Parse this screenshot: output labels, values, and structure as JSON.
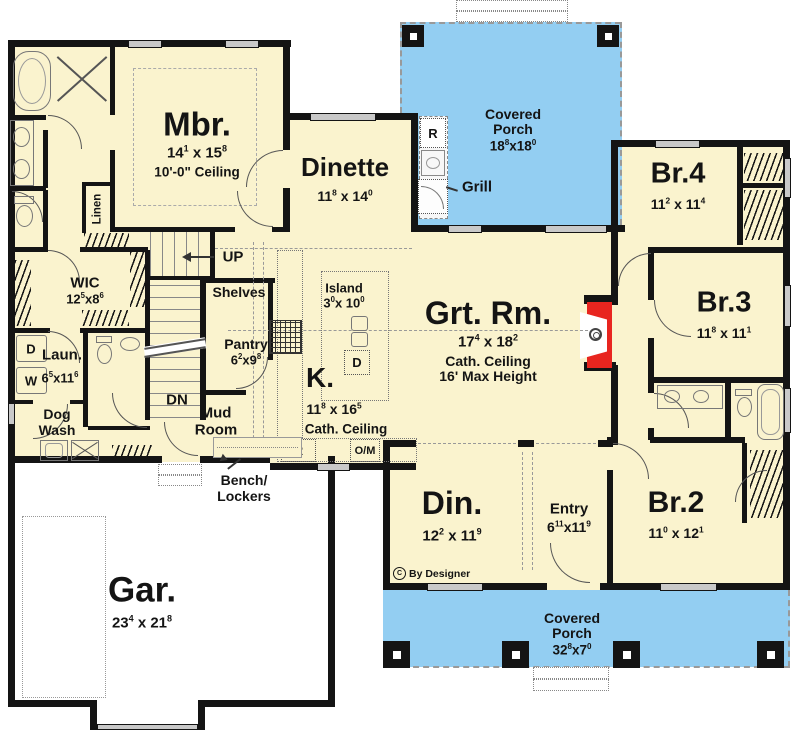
{
  "rooms": {
    "mbr": {
      "name": "Mbr.",
      "dim": [
        {
          "t": "14"
        },
        {
          "t": "1",
          "sup": true
        },
        {
          "t": " x 15"
        },
        {
          "t": "8",
          "sup": true
        }
      ],
      "note": "10'-0\" Ceiling"
    },
    "dinette": {
      "name": "Dinette",
      "dim": [
        {
          "t": "11"
        },
        {
          "t": "8",
          "sup": true
        },
        {
          "t": " x 14"
        },
        {
          "t": "0",
          "sup": true
        }
      ]
    },
    "porch_top": {
      "line1": "Covered",
      "line2": "Porch",
      "dim": [
        {
          "t": "18"
        },
        {
          "t": "8",
          "sup": true
        },
        {
          "t": "x18"
        },
        {
          "t": "0",
          "sup": true
        }
      ]
    },
    "br4": {
      "name": "Br.4",
      "dim": [
        {
          "t": "11"
        },
        {
          "t": "2",
          "sup": true
        },
        {
          "t": " x 11"
        },
        {
          "t": "4",
          "sup": true
        }
      ]
    },
    "br3": {
      "name": "Br.3",
      "dim": [
        {
          "t": "11"
        },
        {
          "t": "8",
          "sup": true
        },
        {
          "t": " x 11"
        },
        {
          "t": "1",
          "sup": true
        }
      ]
    },
    "grt": {
      "name": "Grt. Rm.",
      "dim": [
        {
          "t": "17"
        },
        {
          "t": "4",
          "sup": true
        },
        {
          "t": " x 18"
        },
        {
          "t": "2",
          "sup": true
        }
      ],
      "note1": "Cath. Ceiling",
      "note2": "16' Max Height"
    },
    "kitchen": {
      "name": "K.",
      "dim": [
        {
          "t": "11"
        },
        {
          "t": "8",
          "sup": true
        },
        {
          "t": " x 16"
        },
        {
          "t": "5",
          "sup": true
        }
      ],
      "note": "Cath. Ceiling"
    },
    "island": {
      "name": "Island",
      "dim": [
        {
          "t": "3"
        },
        {
          "t": "0",
          "sup": true
        },
        {
          "t": "x 10"
        },
        {
          "t": "0",
          "sup": true
        }
      ]
    },
    "pantry": {
      "name": "Pantry",
      "dim": [
        {
          "t": "6"
        },
        {
          "t": "2",
          "sup": true
        },
        {
          "t": "x9"
        },
        {
          "t": "8",
          "sup": true
        }
      ],
      "shelves": "Shelves"
    },
    "wic": {
      "name": "WIC",
      "dim": [
        {
          "t": "12"
        },
        {
          "t": "5",
          "sup": true
        },
        {
          "t": "x8"
        },
        {
          "t": "6",
          "sup": true
        }
      ]
    },
    "laun": {
      "name": "Laun.",
      "dim": [
        {
          "t": "6"
        },
        {
          "t": "5",
          "sup": true
        },
        {
          "t": "x11"
        },
        {
          "t": "6",
          "sup": true
        }
      ]
    },
    "dog_wash": {
      "line1": "Dog",
      "line2": "Wash"
    },
    "mud_room": {
      "line1": "Mud",
      "line2": "Room"
    },
    "bench": {
      "line1": "Bench/",
      "line2": "Lockers"
    },
    "linen": {
      "name": "Linen"
    },
    "din": {
      "name": "Din.",
      "dim": [
        {
          "t": "12"
        },
        {
          "t": "2",
          "sup": true
        },
        {
          "t": " x 11"
        },
        {
          "t": "9",
          "sup": true
        }
      ]
    },
    "entry": {
      "name": "Entry",
      "dim": [
        {
          "t": "6"
        },
        {
          "t": "11",
          "sup": true
        },
        {
          "t": "x11"
        },
        {
          "t": "9",
          "sup": true
        }
      ]
    },
    "br2": {
      "name": "Br.2",
      "dim": [
        {
          "t": "11"
        },
        {
          "t": "0",
          "sup": true
        },
        {
          "t": " x 12"
        },
        {
          "t": "1",
          "sup": true
        }
      ]
    },
    "gar": {
      "name": "Gar.",
      "dim": [
        {
          "t": "23"
        },
        {
          "t": "4",
          "sup": true
        },
        {
          "t": " x 21"
        },
        {
          "t": "8",
          "sup": true
        }
      ]
    },
    "porch_bottom": {
      "line1": "Covered",
      "line2": "Porch",
      "dim": [
        {
          "t": "32"
        },
        {
          "t": "8",
          "sup": true
        },
        {
          "t": "x7"
        },
        {
          "t": "0",
          "sup": true
        }
      ]
    }
  },
  "stairs": {
    "up": "UP",
    "dn": "DN"
  },
  "appliances": {
    "range": "R",
    "oven_microwave": "O/M",
    "dishwasher": "D",
    "dryer": "D",
    "washer": "W",
    "fridge": "R",
    "grill": "Grill"
  },
  "copyright": {
    "symbol": "C",
    "text": "By Designer"
  },
  "colors": {
    "floor": "#FAF3CE",
    "porch": "#93CEF2",
    "wall": "#141414",
    "fireplace": "#E8251F",
    "window_fill": "#C9C9C9"
  }
}
